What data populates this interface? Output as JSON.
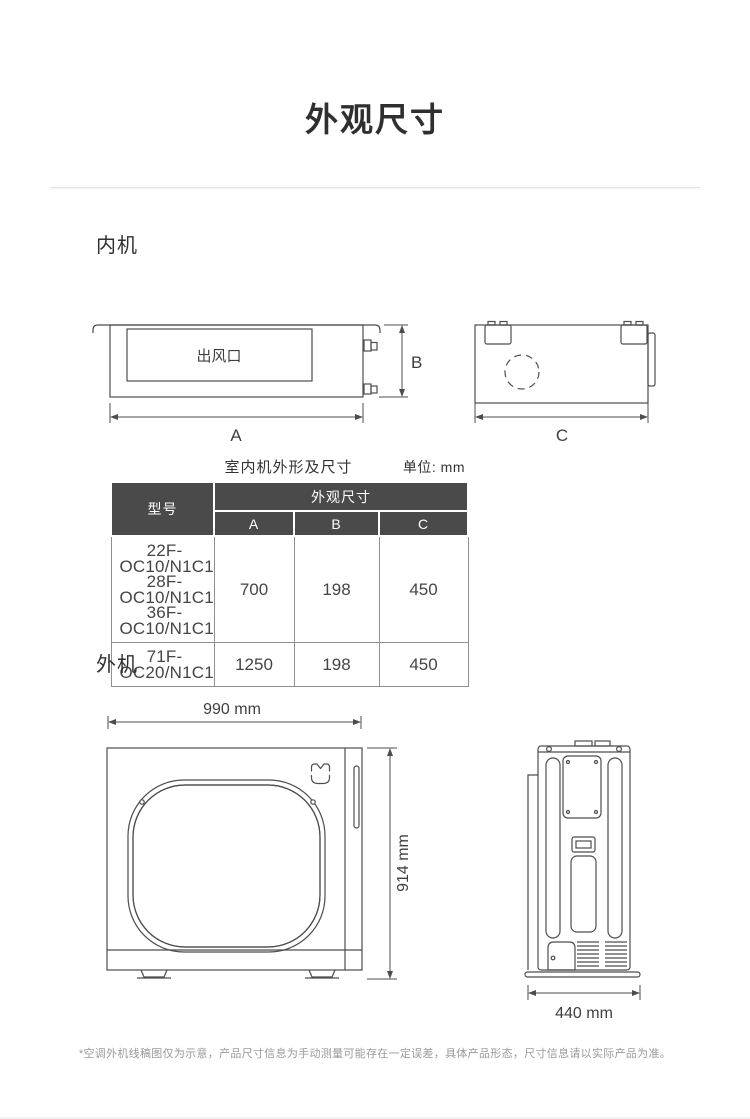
{
  "page": {
    "title": "外观尺寸",
    "footnote": "*空调外机线稿图仅为示意，产品尺寸信息为手动测量可能存在一定误差，具体产品形态，尺寸信息请以实际产品为准。"
  },
  "indoor": {
    "section_label": "内机",
    "front_view": {
      "outlet_label": "出风口",
      "dim_width_label": "A",
      "dim_height_label": "B"
    },
    "side_view": {
      "dim_depth_label": "C"
    },
    "table": {
      "title": "室内机外形及尺寸",
      "unit_label": "单位: mm",
      "col_model": "型号",
      "col_group": "外观尺寸",
      "col_a": "A",
      "col_b": "B",
      "col_c": "C",
      "rows": [
        {
          "model_lines": [
            "22F-OC10/N1C1",
            "28F-OC10/N1C1",
            "36F-OC10/N1C1"
          ],
          "a": "700",
          "b": "198",
          "c": "450"
        },
        {
          "model_lines": [
            "71F-OC20/N1C1"
          ],
          "a": "1250",
          "b": "198",
          "c": "450"
        }
      ]
    }
  },
  "outdoor": {
    "section_label": "外机",
    "front_view": {
      "width_label": "990 mm",
      "height_label": "914 mm"
    },
    "side_view": {
      "depth_label": "440 mm"
    }
  },
  "colors": {
    "table_header_bg": "#4a4a4a",
    "table_header_text": "#ffffff",
    "table_body_border": "#8f8f8f",
    "drawing_line": "#4d4d4d",
    "divider": "#e3e3e3",
    "footnote_text": "#9a9a9a"
  }
}
